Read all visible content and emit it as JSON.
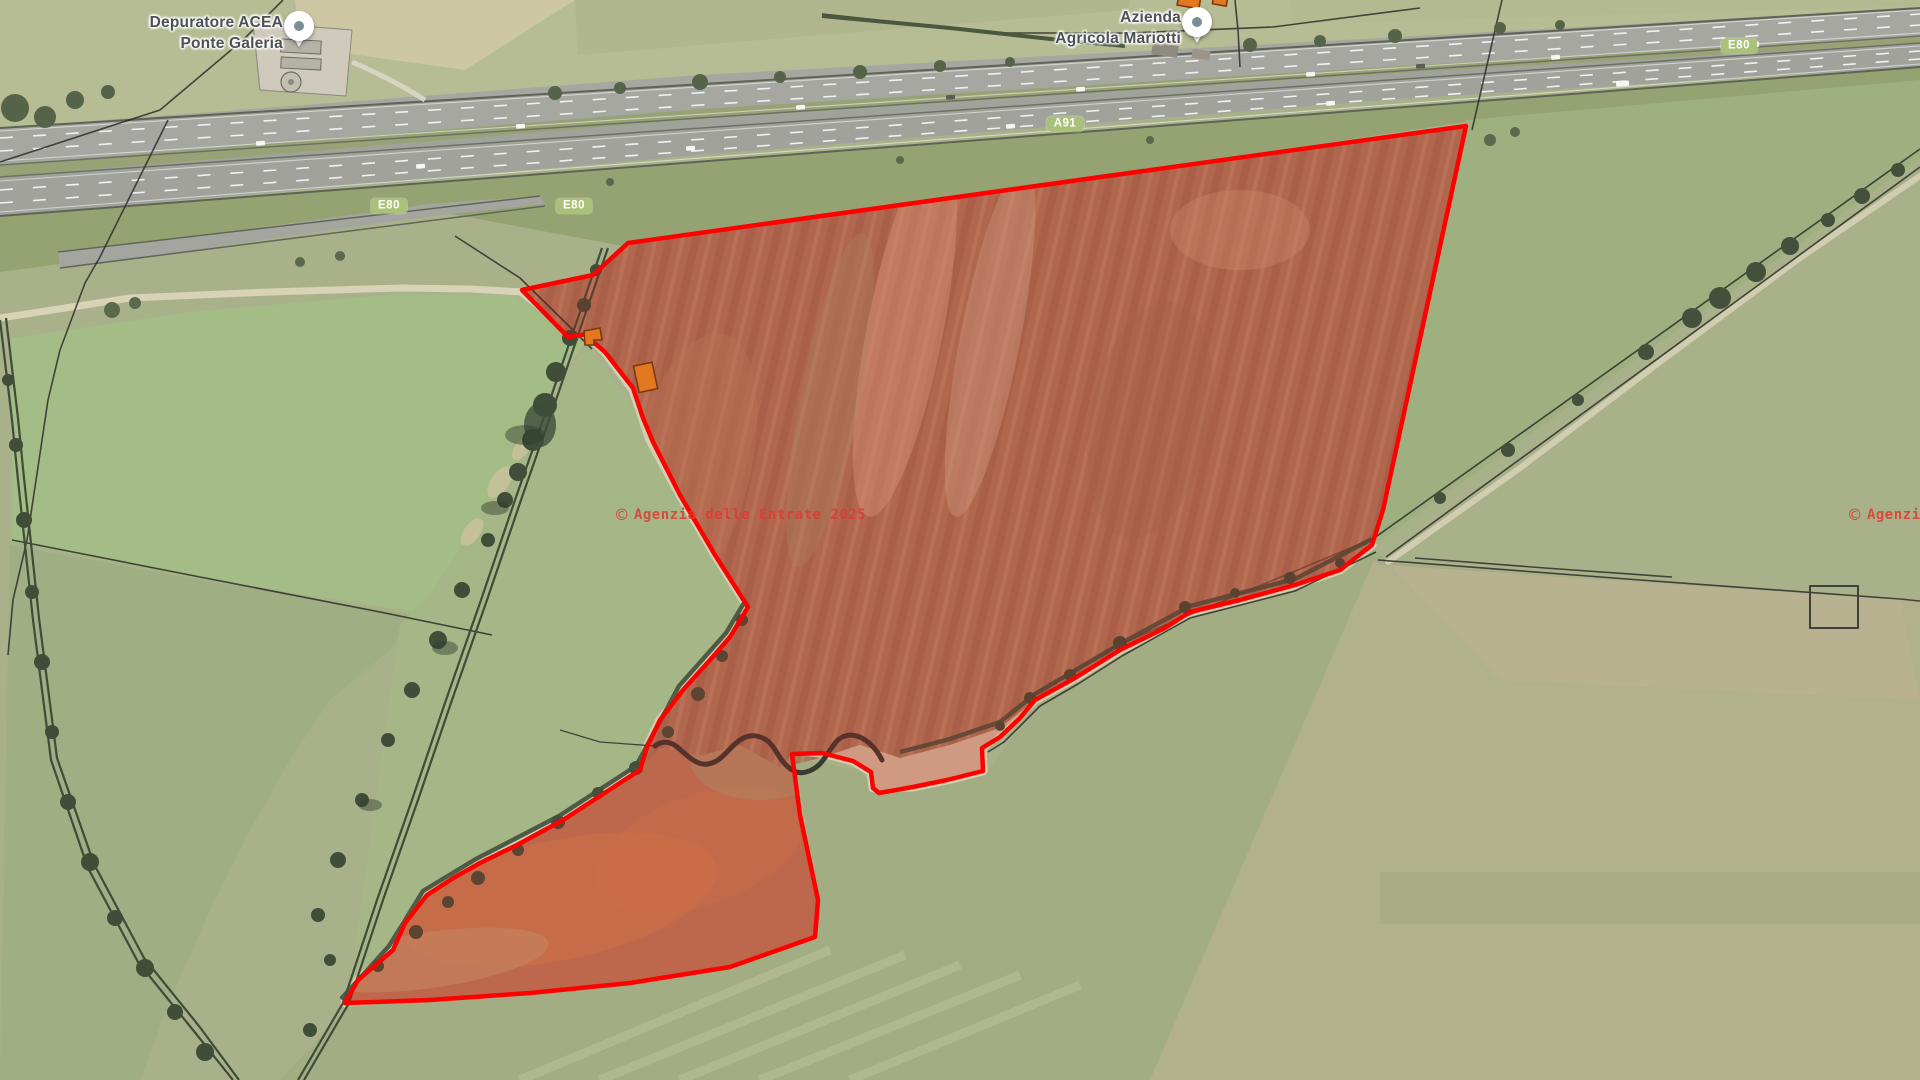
{
  "map": {
    "watermark": {
      "symbol": "©",
      "text": "Agenzia delle Entrate 2025"
    },
    "labels": {
      "depuratore": {
        "line1": "Depuratore ACEA",
        "line2": "Ponte Galeria"
      },
      "azienda": {
        "line1": "Azienda",
        "line2": "Agricola Mariotti"
      }
    },
    "road_badges": {
      "e80_west_1": "E80",
      "e80_west_2": "E80",
      "a91": "A91",
      "e80_east": "E80"
    },
    "colors": {
      "parcel_outline": "#ff0000",
      "parcel_fill_opacity": "0.14",
      "building_highlight": "#e2781f",
      "building_outline": "#7a3a10",
      "badge_background": "#a9c178",
      "badge_text": "#ffffff",
      "watermark": "#e03a30",
      "label_text": "#4d5156",
      "pin_dot": "#7c8d93"
    }
  }
}
